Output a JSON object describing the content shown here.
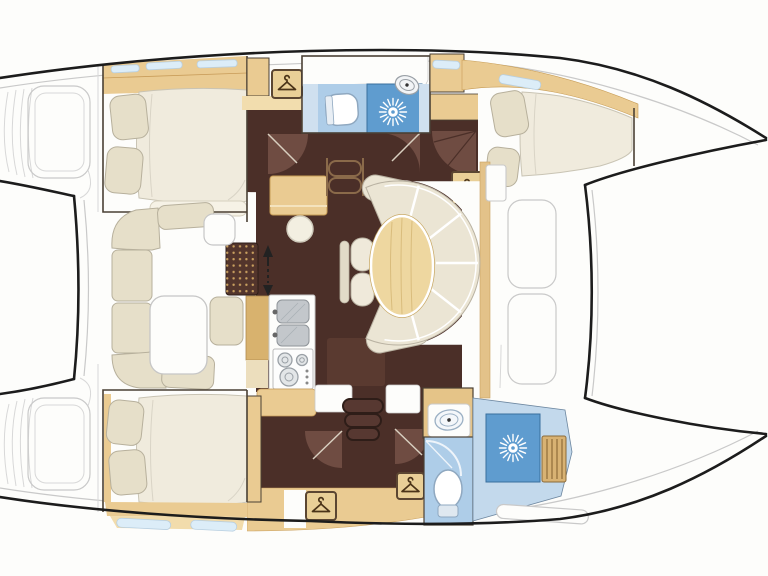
{
  "diagram": {
    "type": "floor-plan",
    "subject": "catamaran-yacht-interior-top-down-layout",
    "rooms": [
      {
        "id": "upper-aft-cabin",
        "kind": "double-berth-cabin"
      },
      {
        "id": "upper-head",
        "kind": "bathroom-with-shower"
      },
      {
        "id": "upper-forward-cabin",
        "kind": "double-berth-cabin"
      },
      {
        "id": "lower-aft-cabin",
        "kind": "double-berth-cabin"
      },
      {
        "id": "lower-head",
        "kind": "bathroom"
      },
      {
        "id": "lower-shower-room",
        "kind": "shower-compartment"
      },
      {
        "id": "salon",
        "kind": "main-saloon"
      },
      {
        "id": "dinette",
        "kind": "curved-settee-with-oval-table"
      },
      {
        "id": "port-settee",
        "kind": "c-shaped-settee-with-table"
      },
      {
        "id": "galley",
        "kind": "galley-with-sink-and-stove"
      },
      {
        "id": "nav-station",
        "kind": "chart-desk-with-stool"
      },
      {
        "id": "foredeck",
        "kind": "trampoline-area"
      },
      {
        "id": "stern-platforms",
        "kind": "transom-steps"
      }
    ],
    "fixtures": {
      "beds": 3,
      "pillows": 6,
      "toilets": 2,
      "bathroom-sinks": 2,
      "galley-sink-basins": 2,
      "stove-burners": 3,
      "shower-heads": 2,
      "wardrobe-hanger-icons": 4,
      "companionway-stairs": 2,
      "door-swings": 6
    },
    "icons": [
      "hanger-icon",
      "shower-head-icon",
      "sink-icon",
      "toilet-icon",
      "stove-burner-icon",
      "stairs-direction-arrow-icon"
    ]
  },
  "palette": {
    "paper": "#ffffff",
    "outline": "#1c1c1c",
    "wall": "#4a4034",
    "deck_line": "#c9c9c9",
    "floor_dark": "#4b2f28",
    "floor_panel": "#5a3a30",
    "door_fan": "#6f4c42",
    "wood_tan": "#eacb92",
    "wood_tan_dark": "#d8b26e",
    "wood_edge": "#c89c59",
    "counter_beige": "#ecdebd",
    "cushion": "#e6dfc9",
    "cushion_edge": "#b7b09c",
    "mattress": "#f0ebdd",
    "settee": "#ebe5d4",
    "table_wood": "#eed7a0",
    "table_grain": "#d9bc7c",
    "bath_blue": "#c3d9ec",
    "bath_floor": "#aecde8",
    "shower_blue": "#5f9ccf",
    "window_blue": "#dcedf8",
    "sink_gray": "#c3c7cb",
    "steel_gray": "#9aa0a6",
    "teak": "#d8b273",
    "teak_line": "#9e7a45",
    "hanger_box": "#e9cf97",
    "hanger_stroke": "#5b4632"
  }
}
